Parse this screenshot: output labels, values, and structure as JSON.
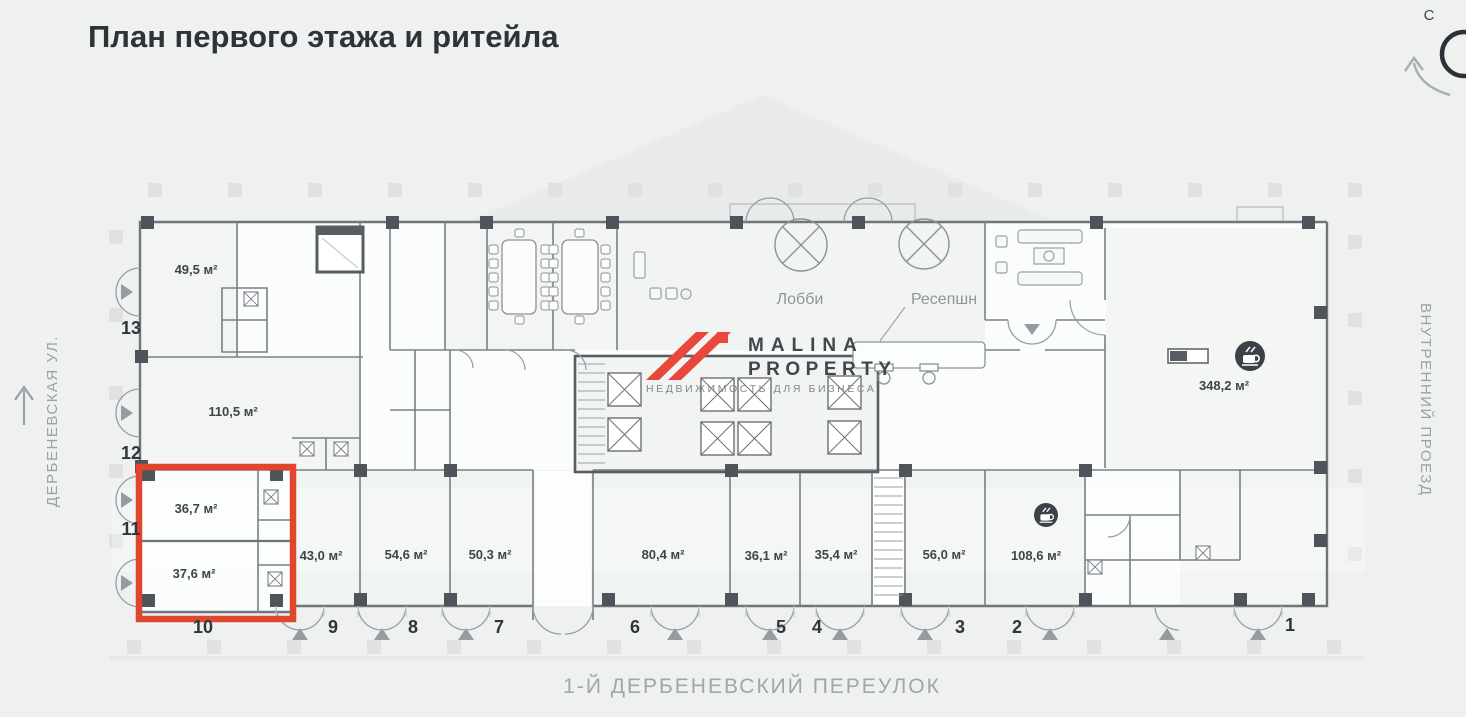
{
  "title": "План первого этажа и ритейла",
  "compass": {
    "north": "С"
  },
  "streets": {
    "left": "ДЕРБЕНЕВСКАЯ УЛ.",
    "right": "ВНУТРЕННИЙ ПРОЕЗД",
    "bottom": "1-Й ДЕРБЕНЕВСКИЙ ПЕРЕУЛОК"
  },
  "logo": {
    "line1": "MALINA",
    "line2": "PROPERTY",
    "tagline": "НЕДВИЖИМОСТЬ ДЛЯ БИЗНЕСА"
  },
  "plan": {
    "labels": {
      "lobby": "Лобби",
      "reception": "Ресепшн"
    },
    "areas": {
      "a13": "49,5 м²",
      "a12": "110,5 м²",
      "a11": "36,7 м²",
      "a10": "37,6 м²",
      "a9": "43,0 м²",
      "a8": "54,6 м²",
      "a7": "50,3 м²",
      "a6": "80,4 м²",
      "a5": "36,1 м²",
      "a4": "35,4 м²",
      "a3": "56,0 м²",
      "a2": "108,6 м²",
      "cafe": "348,2 м²"
    },
    "numbers": {
      "n13": "13",
      "n12": "12",
      "n11": "11",
      "n10": "10",
      "n9": "9",
      "n8": "8",
      "n7": "7",
      "n6": "6",
      "n5": "5",
      "n4": "4",
      "n3": "3",
      "n2": "2",
      "n1": "1"
    },
    "icons": {
      "cafe_large": "coffee-cup",
      "cafe_small": "coffee-cup"
    },
    "colors": {
      "highlight": "#e0462d",
      "logo_red": "#e8473a"
    }
  }
}
